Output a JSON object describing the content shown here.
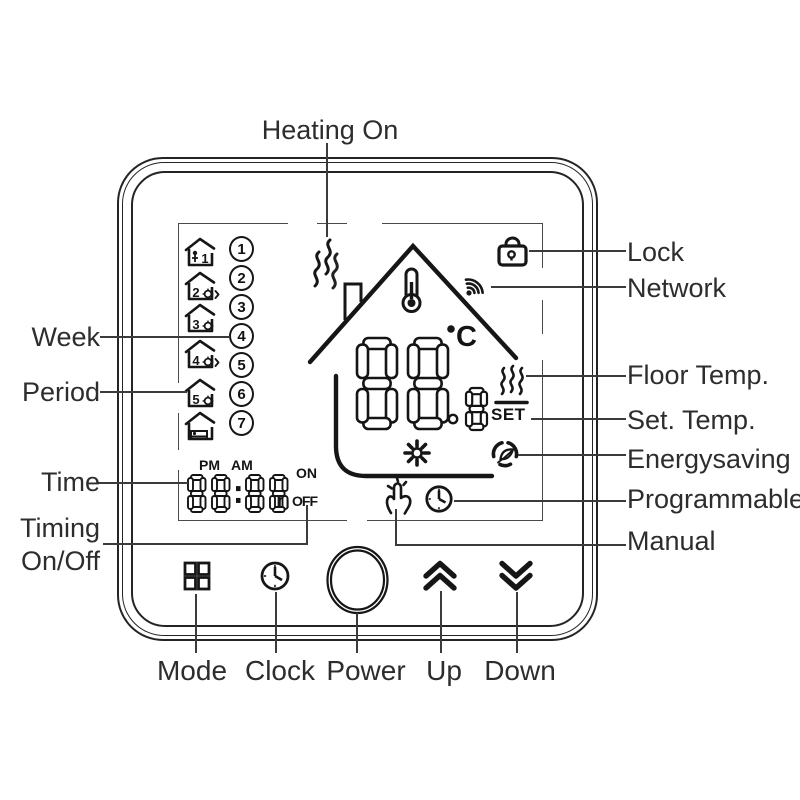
{
  "callouts": {
    "heating_on": "Heating On",
    "week": "Week",
    "period": "Period",
    "time": "Time",
    "timing_line1": "Timing",
    "timing_line2": "On/Off",
    "lock": "Lock",
    "network": "Network",
    "floor_temp": "Floor Temp.",
    "set_temp": "Set. Temp.",
    "energysaving": "Energysaving",
    "programmable": "Programmable",
    "manual": "Manual"
  },
  "buttons": {
    "mode": "Mode",
    "clock": "Clock",
    "power": "Power",
    "up": "Up",
    "down": "Down"
  },
  "display": {
    "week_days": [
      "1",
      "2",
      "3",
      "4",
      "5",
      "6",
      "7"
    ],
    "periods": [
      {
        "number": "1",
        "variant": "person"
      },
      {
        "number": "2",
        "variant": "gear-arrow"
      },
      {
        "number": "3",
        "variant": "gear"
      },
      {
        "number": "4",
        "variant": "gear-arrow"
      },
      {
        "number": "5",
        "variant": "gear"
      },
      {
        "number": "",
        "variant": "bed"
      }
    ],
    "pm": "PM",
    "am": "AM",
    "time_value": "88:88",
    "hour_unit": "h",
    "on": "ON",
    "off": "OFF",
    "main_temp": "88",
    "temp_decimal": "8",
    "temp_unit": "C",
    "set": "SET"
  },
  "colors": {
    "ink": "#161616",
    "line": "#3b3b3b",
    "label": "#2d2d2d"
  }
}
